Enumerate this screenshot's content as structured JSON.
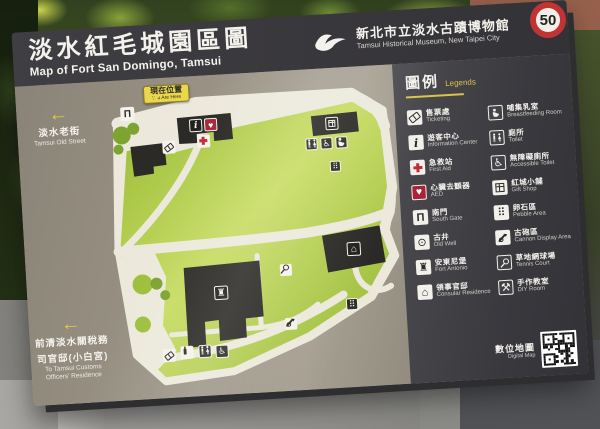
{
  "sign": {
    "title_zh": "淡水紅毛城園區圖",
    "title_en": "Map of Fort San Domingo, Tamsui",
    "museum_zh": "新北市立淡水古蹟博物館",
    "museum_en": "Tamsui Historical Museum, New Taipei City"
  },
  "directions": {
    "old_street_zh": "淡水老街",
    "old_street_en": "Tamsui Old Street",
    "customs_zh1": "前清淡水關稅務",
    "customs_zh2": "司官邸(小白宮)",
    "customs_en1": "To Tamsui Customs",
    "customs_en2": "Officers' Residence",
    "arrow": "←"
  },
  "map": {
    "you_are_here_zh": "現在位置",
    "you_are_here_en": "You Are Here",
    "icons": [
      {
        "name": "map-south-gate-icon",
        "icon": "south-gate-icon"
      },
      {
        "name": "map-ticket-icon",
        "icon": "ticket-icon"
      },
      {
        "name": "map-info-icon",
        "icon": "info-icon"
      },
      {
        "name": "map-aed-icon",
        "icon": "aed-icon"
      },
      {
        "name": "map-first-aid-icon",
        "icon": "first-aid-icon"
      },
      {
        "name": "map-gift-icon",
        "icon": "gift-icon"
      },
      {
        "name": "map-toilet-icon",
        "icon": "toilet-icon"
      },
      {
        "name": "map-wheelchair-icon",
        "icon": "wheelchair-icon"
      },
      {
        "name": "map-nursing-icon",
        "icon": "nursing-icon"
      },
      {
        "name": "map-pebble-icon-1",
        "icon": "pebble-icon"
      },
      {
        "name": "map-residence-icon",
        "icon": "residence-icon"
      },
      {
        "name": "map-fort-icon",
        "icon": "fort-icon"
      },
      {
        "name": "map-tennis-icon",
        "icon": "tennis-icon"
      },
      {
        "name": "map-cannon-icon",
        "icon": "cannon-icon"
      },
      {
        "name": "map-pebble-icon-2",
        "icon": "pebble-icon"
      },
      {
        "name": "map-ticket-icon-2",
        "icon": "ticket-icon"
      },
      {
        "name": "map-drink-icon",
        "icon": "drink-icon"
      },
      {
        "name": "map-toilet-icon-2",
        "icon": "toilet-icon"
      },
      {
        "name": "map-wheelchair-icon-2",
        "icon": "wheelchair-icon"
      }
    ]
  },
  "legend": {
    "title_zh": "圖例",
    "title_en": "Legends",
    "items": [
      {
        "zh": "售票處",
        "en": "Ticketing",
        "icon": "ticket-icon"
      },
      {
        "zh": "遊客中心",
        "en": "Information Center",
        "icon": "info-icon"
      },
      {
        "zh": "急救站",
        "en": "First Aid",
        "icon": "first-aid-icon"
      },
      {
        "zh": "心臟去顫器",
        "en": "AED",
        "icon": "aed-icon"
      },
      {
        "zh": "南門",
        "en": "South Gate",
        "icon": "south-gate-icon"
      },
      {
        "zh": "古井",
        "en": "Old Well",
        "icon": "old-well-icon"
      },
      {
        "zh": "安東尼堡",
        "en": "Fort Antonio",
        "icon": "fort-icon"
      },
      {
        "zh": "領事官邸",
        "en": "Consular Residence",
        "icon": "residence-icon"
      },
      {
        "zh": "哺集乳室",
        "en": "Breastfeeding Room",
        "icon": "nursing-icon"
      },
      {
        "zh": "廁所",
        "en": "Toilet",
        "icon": "toilet-icon"
      },
      {
        "zh": "無障礙廁所",
        "en": "Accessible Toilet",
        "icon": "wheelchair-icon"
      },
      {
        "zh": "紅城小舖",
        "en": "Gift Shop",
        "icon": "gift-icon"
      },
      {
        "zh": "卵石區",
        "en": "Pebble Area",
        "icon": "pebble-icon"
      },
      {
        "zh": "古砲區",
        "en": "Cannon Display Area",
        "icon": "cannon-icon"
      },
      {
        "zh": "草地網球場",
        "en": "Tennis Court",
        "icon": "tennis-icon"
      },
      {
        "zh": "手作教室",
        "en": "DIY Room",
        "icon": "diy-icon"
      }
    ],
    "digital_map_zh": "數位地圖",
    "digital_map_en": "Digital Map"
  },
  "background": {
    "speed_limit": "50"
  },
  "colors": {
    "accent_yellow": "#e3c93f",
    "legend_gold": "#d9c44a",
    "aed_red": "#a8233a",
    "first_aid_red": "#c3293a",
    "lawn_green": "#9dc03c",
    "map_base": "#ece9dc",
    "sign_taupe": "#968d7e",
    "panel_dark": "#434247"
  }
}
